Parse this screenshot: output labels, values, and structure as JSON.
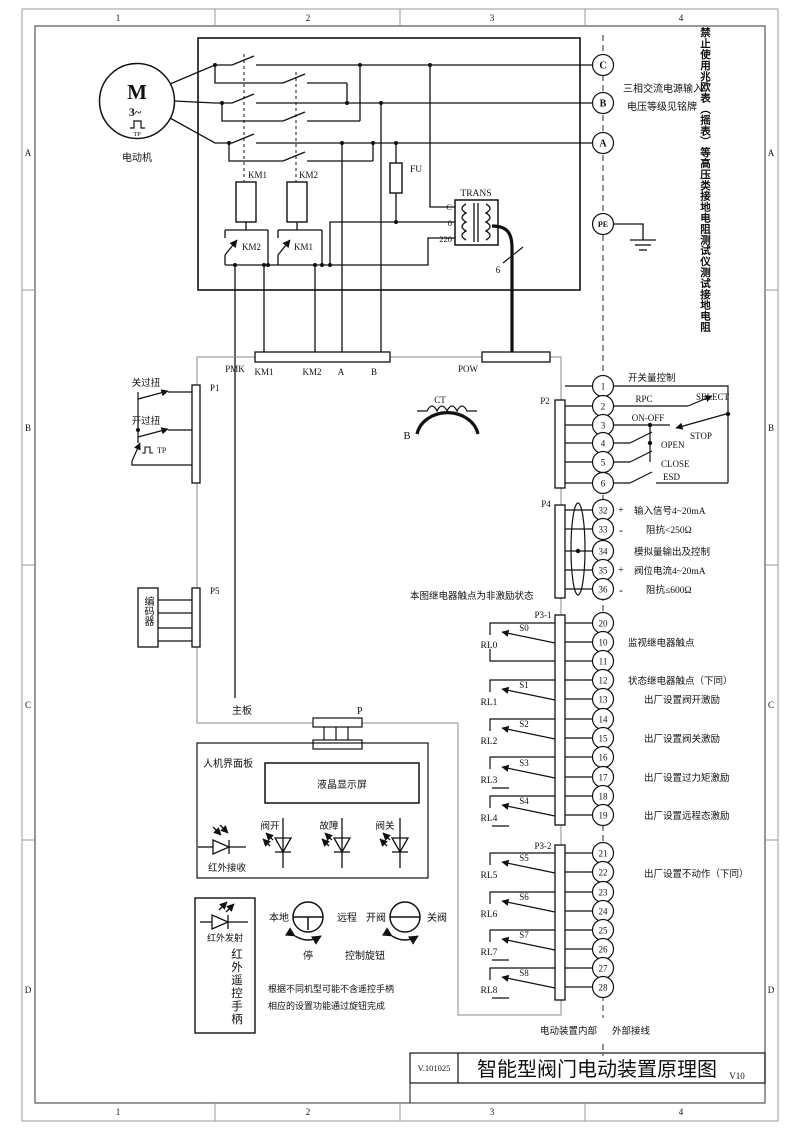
{
  "frame": {
    "cols": [
      "1",
      "2",
      "3",
      "4"
    ],
    "rows": [
      "A",
      "B",
      "C",
      "D"
    ]
  },
  "title_block": {
    "doc_no": "V.101025",
    "title": "智能型阀门电动装置原理图",
    "version": "V10"
  },
  "warning": "禁止使用兆欧表（摇表）等高压类接地电阻测试仪测试接地电阻",
  "motor": {
    "symbol": "M",
    "phase": "3~",
    "tp": "TP",
    "label": "电动机"
  },
  "power_section": {
    "km1": "KM1",
    "km2": "KM2",
    "km1_interlock": "KM2",
    "km2_interlock": "KM1",
    "fu": "FU",
    "trans": "TRANS",
    "tap_c": "C",
    "tap_0": "0",
    "tap_220": "220",
    "wires": "6"
  },
  "supply": {
    "line1": "三相交流电源输入",
    "line2": "电压等级见铭牌",
    "terminals": [
      "C",
      "B",
      "A",
      "PE"
    ]
  },
  "connectors": {
    "pmk": "PMK",
    "pow": "POW",
    "p": "P",
    "p1": "P1",
    "p2": "P2",
    "p4": "P4",
    "p5": "P5",
    "p31": "P3-1",
    "p32": "P3-2",
    "pmk_labels": [
      "KM1",
      "KM2",
      "A",
      "B"
    ],
    "mainboard": "主板"
  },
  "torque": {
    "close": "关过扭",
    "open": "开过扭",
    "tp": "TP"
  },
  "encoder": "编码器",
  "ct": {
    "label": "CT",
    "phase": "B"
  },
  "switch_control": {
    "title": "开关量控制",
    "rpc": "RPC",
    "select": "SELECT",
    "on_off": "ON-OFF",
    "stop": "STOP",
    "open": "OPEN",
    "close": "CLOSE",
    "esd": "ESD"
  },
  "terminals": {
    "p2": [
      "1",
      "2",
      "3",
      "4",
      "5",
      "6"
    ],
    "p4": [
      "32",
      "33",
      "34",
      "35",
      "36"
    ],
    "p31": [
      "20",
      "10",
      "11",
      "12",
      "13",
      "14",
      "15",
      "16",
      "17",
      "18",
      "19"
    ],
    "p32": [
      "21",
      "22",
      "23",
      "24",
      "25",
      "26",
      "27",
      "28"
    ]
  },
  "analog": {
    "plus": "+",
    "minus": "-",
    "l1": "输入信号4~20mA",
    "l2": "阻抗<250Ω",
    "l3": "模拟量输出及控制",
    "l4": "阀位电流4~20mA",
    "l5": "阻抗≤600Ω"
  },
  "relay_note": "本图继电器触点为非激励状态",
  "relays": {
    "names": [
      "RL0",
      "RL1",
      "RL2",
      "RL3",
      "RL4",
      "RL5",
      "RL6",
      "RL7",
      "RL8"
    ],
    "switches": [
      "S0",
      "S1",
      "S2",
      "S3",
      "S4",
      "S5",
      "S6",
      "S7",
      "S8"
    ],
    "desc_monitor": "监视继电器触点",
    "desc_status": "状态继电器触点（下同）",
    "desc_open": "出厂设置阀开激励",
    "desc_close": "出厂设置阀关激励",
    "desc_torque": "出厂设置过力矩激励",
    "desc_remote": "出厂设置远程态激励",
    "desc_noact": "出厂设置不动作（下同）"
  },
  "hmi": {
    "panel": "人机界面板",
    "lcd": "液晶显示屏",
    "led_open": "阀开",
    "led_fault": "故障",
    "led_close": "阀关",
    "ir_rx": "红外接收",
    "ir_tx": "红外发射",
    "ir_handle": "红外遥控手柄",
    "local": "本地",
    "remote": "远程",
    "stop": "停",
    "open_valve": "开阀",
    "close_valve": "关阀",
    "knob": "控制旋钮",
    "note1": "根据不同机型可能不含遥控手柄",
    "note2": "相应的设置功能通过旋钮完成"
  },
  "boundary": {
    "internal": "电动装置内部",
    "external": "外部接线"
  }
}
